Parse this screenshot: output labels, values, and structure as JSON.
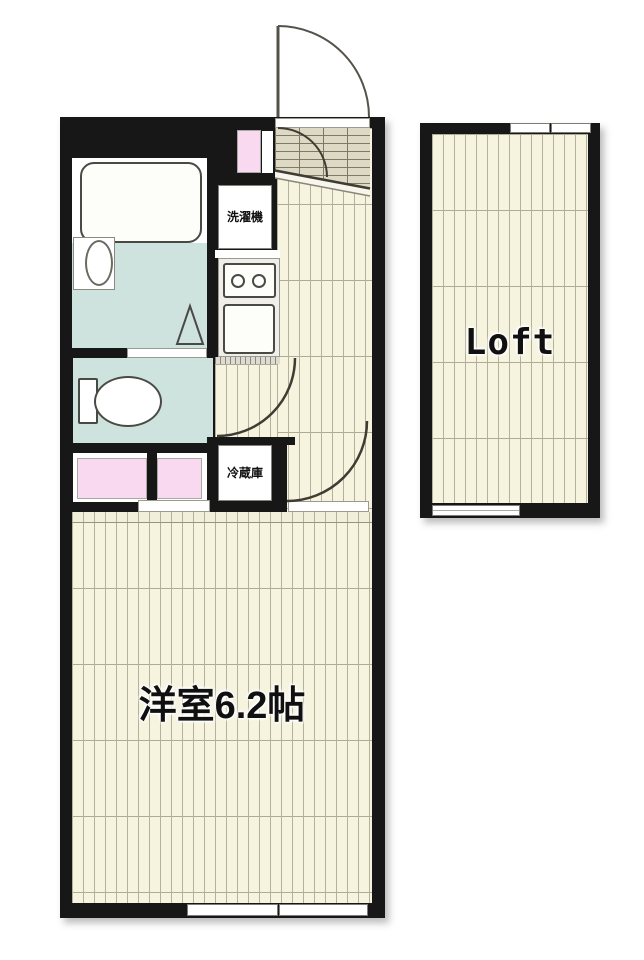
{
  "floorplan": {
    "type": "apartment-floor-plan",
    "labels": {
      "washing_machine": "洗濯機",
      "refrigerator": "冷蔵庫",
      "main_room": "洋室6.2帖",
      "loft": "Loft"
    },
    "rooms": [
      {
        "name": "unit-bathroom",
        "fixtures": [
          "bathtub",
          "wash-basin",
          "folding-door-mark"
        ]
      },
      {
        "name": "toilet-room",
        "fixtures": [
          "toilet"
        ]
      },
      {
        "name": "washroom",
        "fixtures": [
          "vanity",
          "storage"
        ]
      },
      {
        "name": "kitchen",
        "fixtures": [
          "washing-machine-space",
          "two-burner-stove",
          "kitchen-sink",
          "refrigerator-space"
        ]
      },
      {
        "name": "entrance-genkan",
        "fixtures": [
          "front-door",
          "shoe-cabinet"
        ]
      },
      {
        "name": "western-room",
        "size_label": "洋室6.2帖"
      },
      {
        "name": "loft",
        "size_label": "Loft"
      }
    ],
    "colors": {
      "wall": "#171717",
      "wood_floor": "#f6f3df",
      "wet_area_floor": "#cfe3de",
      "pink_fixture": "#f9d9ef",
      "entrance_tile": "#ded9c4",
      "background": "#ffffff"
    }
  }
}
